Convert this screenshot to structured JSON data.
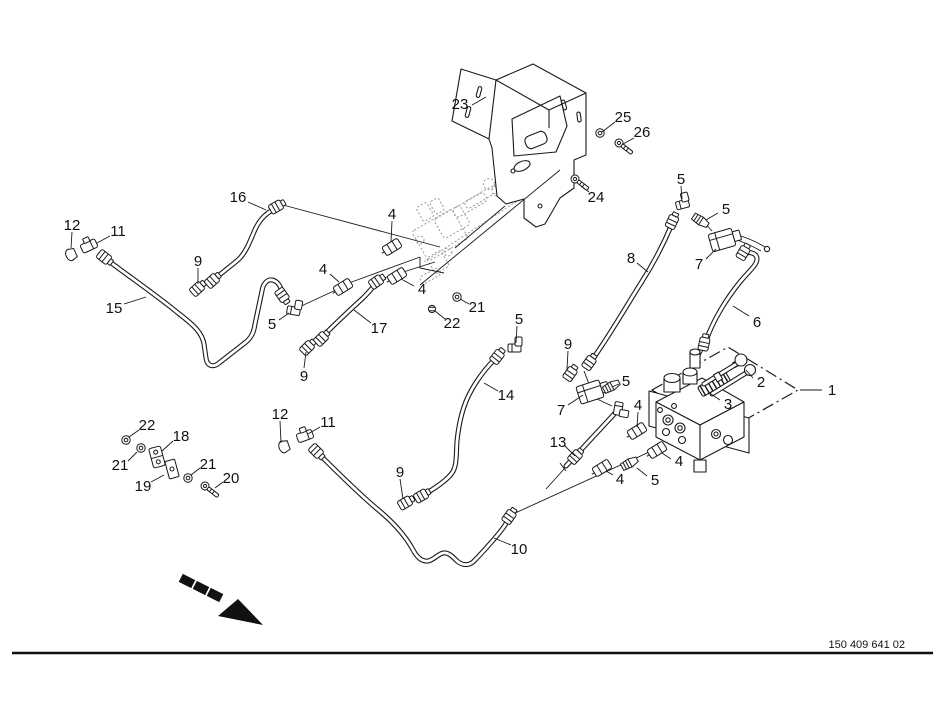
{
  "page": {
    "type": "exploded-parts-diagram",
    "subject": "hydraulic hoses and control valve assembly"
  },
  "colors": {
    "background": "#ffffff",
    "line": "#1a1a1a",
    "ghost_line": "#9a9a9a",
    "text": "#111111"
  },
  "footer": {
    "drawing_number": "150 409 641 02"
  },
  "diagram": {
    "callouts": [
      {
        "t": "23",
        "tx": 460,
        "ty": 104,
        "sx": 472,
        "sy": 105,
        "ex": 486,
        "ey": 97
      },
      {
        "t": "25",
        "tx": 623,
        "ty": 117,
        "sx": 615,
        "sy": 122,
        "ex": 602,
        "ey": 132
      },
      {
        "t": "26",
        "tx": 642,
        "ty": 132,
        "sx": 634,
        "sy": 138,
        "ex": 623,
        "ey": 144
      },
      {
        "t": "24",
        "tx": 596,
        "ty": 197,
        "sx": 589,
        "sy": 192,
        "ex": 581,
        "ey": 186
      },
      {
        "t": "5",
        "tx": 681,
        "ty": 179,
        "sx": 681,
        "sy": 186,
        "ex": 682,
        "ey": 199
      },
      {
        "t": "5",
        "tx": 726,
        "ty": 209,
        "sx": 718,
        "sy": 213,
        "ex": 706,
        "ey": 220
      },
      {
        "t": "7",
        "tx": 699,
        "ty": 264,
        "sx": 706,
        "sy": 259,
        "ex": 716,
        "ey": 249
      },
      {
        "t": "16",
        "tx": 238,
        "ty": 197,
        "sx": 248,
        "sy": 202,
        "ex": 266,
        "ey": 210
      },
      {
        "t": "12",
        "tx": 72,
        "ty": 225,
        "sx": 72,
        "sy": 232,
        "ex": 71,
        "ey": 248
      },
      {
        "t": "11",
        "tx": 118,
        "ty": 231,
        "sx": 110,
        "sy": 236,
        "ex": 97,
        "ey": 243
      },
      {
        "t": "9",
        "tx": 198,
        "ty": 261,
        "sx": 198,
        "sy": 268,
        "ex": 198,
        "ey": 284
      },
      {
        "t": "4",
        "tx": 392,
        "ty": 214,
        "sx": 392,
        "sy": 221,
        "ex": 391,
        "ey": 242
      },
      {
        "t": "4",
        "tx": 323,
        "ty": 269,
        "sx": 330,
        "sy": 274,
        "ex": 339,
        "ey": 282
      },
      {
        "t": "4",
        "tx": 422,
        "ty": 289,
        "sx": 414,
        "sy": 286,
        "ex": 401,
        "ey": 279
      },
      {
        "t": "21",
        "tx": 477,
        "ty": 307,
        "sx": 469,
        "sy": 304,
        "ex": 460,
        "ey": 299
      },
      {
        "t": "22",
        "tx": 452,
        "ty": 323,
        "sx": 445,
        "sy": 319,
        "ex": 435,
        "ey": 311
      },
      {
        "t": "15",
        "tx": 114,
        "ty": 308,
        "sx": 124,
        "sy": 304,
        "ex": 146,
        "ey": 297
      },
      {
        "t": "5",
        "tx": 272,
        "ty": 324,
        "sx": 279,
        "sy": 320,
        "ex": 289,
        "ey": 313
      },
      {
        "t": "17",
        "tx": 379,
        "ty": 328,
        "sx": 371,
        "sy": 323,
        "ex": 354,
        "ey": 310
      },
      {
        "t": "9",
        "tx": 304,
        "ty": 376,
        "sx": 304,
        "sy": 368,
        "ex": 306,
        "ey": 352
      },
      {
        "t": "8",
        "tx": 631,
        "ty": 258,
        "sx": 637,
        "sy": 263,
        "ex": 648,
        "ey": 272
      },
      {
        "t": "6",
        "tx": 757,
        "ty": 322,
        "sx": 749,
        "sy": 316,
        "ex": 733,
        "ey": 306
      },
      {
        "t": "5",
        "tx": 519,
        "ty": 319,
        "sx": 517,
        "sy": 326,
        "ex": 516,
        "ey": 343
      },
      {
        "t": "9",
        "tx": 568,
        "ty": 344,
        "sx": 568,
        "sy": 351,
        "ex": 567,
        "ey": 369
      },
      {
        "t": "7",
        "tx": 561,
        "ty": 410,
        "sx": 568,
        "sy": 405,
        "ex": 583,
        "ey": 395
      },
      {
        "t": "5",
        "tx": 626,
        "ty": 381,
        "sx": 619,
        "sy": 384,
        "ex": 612,
        "ey": 387
      },
      {
        "t": "13",
        "tx": 558,
        "ty": 442,
        "sx": 565,
        "sy": 446,
        "ex": 575,
        "ey": 456
      },
      {
        "t": "14",
        "tx": 506,
        "ty": 395,
        "sx": 498,
        "sy": 391,
        "ex": 484,
        "ey": 383
      },
      {
        "t": "2",
        "tx": 761,
        "ty": 382,
        "sx": 753,
        "sy": 378,
        "ex": 746,
        "ey": 370
      },
      {
        "t": "3",
        "tx": 728,
        "ty": 404,
        "sx": 720,
        "sy": 400,
        "ex": 708,
        "ey": 392
      },
      {
        "t": "1",
        "tx": 832,
        "ty": 390,
        "sx": 822,
        "sy": 390,
        "ex": 800,
        "ey": 390
      },
      {
        "t": "4",
        "tx": 638,
        "ty": 405,
        "sx": 638,
        "sy": 412,
        "ex": 637,
        "ey": 427
      },
      {
        "t": "4",
        "tx": 679,
        "ty": 461,
        "sx": 671,
        "sy": 459,
        "ex": 662,
        "ey": 453
      },
      {
        "t": "4",
        "tx": 620,
        "ty": 479,
        "sx": 613,
        "sy": 475,
        "ex": 606,
        "ey": 471
      },
      {
        "t": "5",
        "tx": 655,
        "ty": 480,
        "sx": 647,
        "sy": 476,
        "ex": 637,
        "ey": 468
      },
      {
        "t": "9",
        "tx": 400,
        "ty": 472,
        "sx": 400,
        "sy": 479,
        "ex": 403,
        "ey": 499
      },
      {
        "t": "10",
        "tx": 519,
        "ty": 549,
        "sx": 511,
        "sy": 545,
        "ex": 494,
        "ey": 538
      },
      {
        "t": "12",
        "tx": 280,
        "ty": 414,
        "sx": 280,
        "sy": 421,
        "ex": 281,
        "ey": 443
      },
      {
        "t": "11",
        "tx": 328,
        "ty": 422,
        "sx": 320,
        "sy": 427,
        "ex": 308,
        "ey": 434
      },
      {
        "t": "22",
        "tx": 147,
        "ty": 425,
        "sx": 139,
        "sy": 430,
        "ex": 129,
        "ey": 437
      },
      {
        "t": "18",
        "tx": 181,
        "ty": 436,
        "sx": 173,
        "sy": 441,
        "ex": 162,
        "ey": 451
      },
      {
        "t": "21",
        "tx": 120,
        "ty": 465,
        "sx": 128,
        "sy": 461,
        "ex": 137,
        "ey": 452
      },
      {
        "t": "19",
        "tx": 143,
        "ty": 486,
        "sx": 151,
        "sy": 482,
        "ex": 164,
        "ey": 475
      },
      {
        "t": "21",
        "tx": 208,
        "ty": 464,
        "sx": 200,
        "sy": 468,
        "ex": 191,
        "ey": 475
      },
      {
        "t": "20",
        "tx": 231,
        "ty": 478,
        "sx": 223,
        "sy": 482,
        "ex": 215,
        "ey": 488
      }
    ]
  }
}
